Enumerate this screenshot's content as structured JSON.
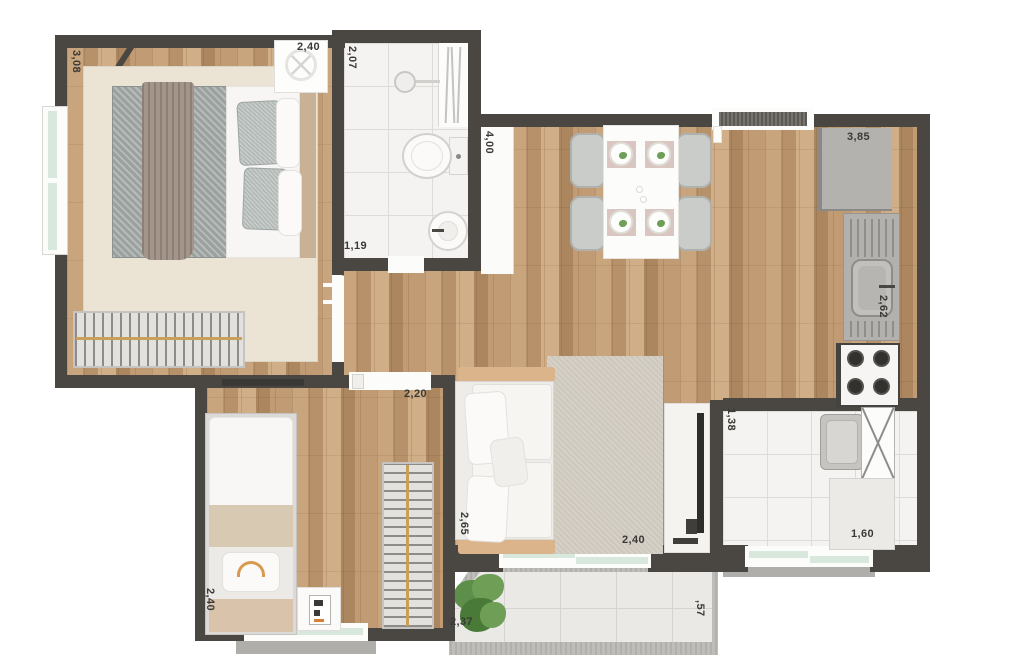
{
  "palette": {
    "wall": "#4a4743",
    "wood_base": "#bd9a73",
    "tile": "#f4f3f1",
    "glass": "#d9e8dc",
    "label": "#3b3a37",
    "rod": "#c9a05a",
    "rug_bedroom": "#ebe4d4",
    "rug_living": "#cdc7bc",
    "blanket_gray": "#9ba19e",
    "blanket_beige": "#d8cab2",
    "plant_green": "#6fa258",
    "appliance_gray": "#b4b2af"
  },
  "labels": {
    "bedroom1_length": "3,08",
    "bedroom1_width": "2,40",
    "bathroom_length": "2,07",
    "bathroom_width": "1,19",
    "living_length": "4,00",
    "kitchen_width": "3,85",
    "kitchen_counter": "2,62",
    "bedroom2_width": "2,20",
    "bedroom2_length": "2,40",
    "sofa_wall": "2,65",
    "living_width": "2,40",
    "laundry_depth": "1,38",
    "laundry_width": "1,60",
    "balcony_width": "2,37",
    "balcony_depth": ",57"
  }
}
